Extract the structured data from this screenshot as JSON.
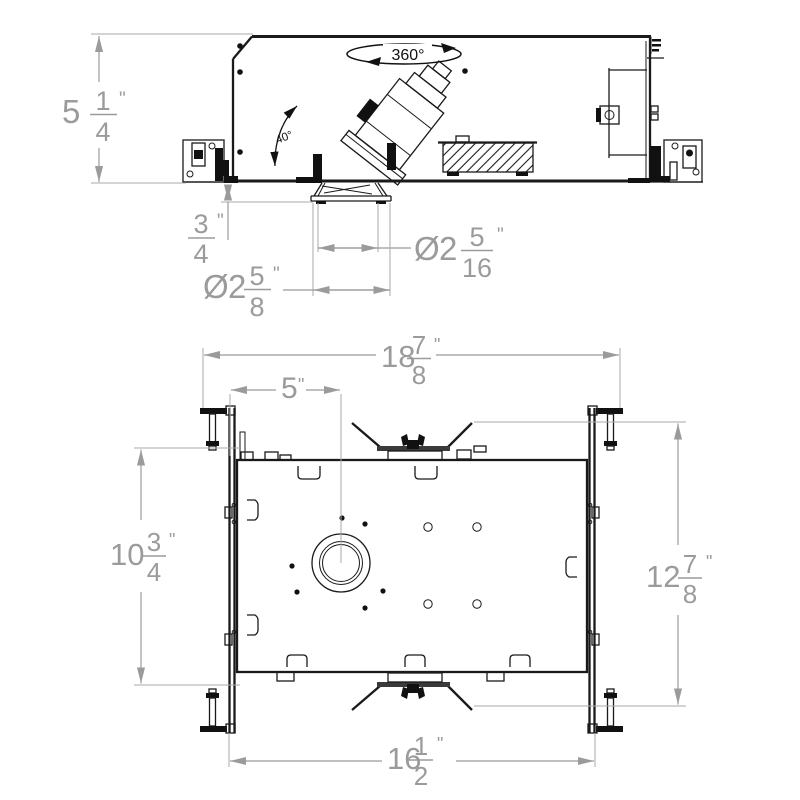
{
  "drawing": {
    "type": "technical-dimension-drawing",
    "subject": "recessed-downlight-housing",
    "colors": {
      "line": "#1a1a1a",
      "dimension": "#9b9b9b",
      "annotation_text": "#111111"
    },
    "annotations": {
      "rotation": "360°",
      "tilt": "40°"
    },
    "side_view": {
      "dims": {
        "housing_height": {
          "whole": "5",
          "num": "1",
          "den": "4",
          "unit": "\""
        },
        "trim_depth": {
          "whole": "",
          "num": "3",
          "den": "4",
          "unit": "\""
        },
        "trim_diameter": {
          "prefix": "Ø",
          "whole": "2",
          "num": "5",
          "den": "8",
          "unit": "\""
        },
        "aperture_diameter": {
          "prefix": "Ø",
          "whole": "2",
          "num": "5",
          "den": "16",
          "unit": "\""
        }
      }
    },
    "plan_view": {
      "dims": {
        "overall_width": {
          "whole": "18",
          "num": "7",
          "den": "8",
          "unit": "\""
        },
        "center_offset": {
          "whole": "5",
          "num": "",
          "den": "",
          "unit": "\""
        },
        "housing_length": {
          "whole": "10",
          "num": "3",
          "den": "4",
          "unit": "\""
        },
        "bar_length": {
          "whole": "12",
          "num": "7",
          "den": "8",
          "unit": "\""
        },
        "bar_span": {
          "whole": "16",
          "num": "1",
          "den": "2",
          "unit": "\""
        }
      }
    }
  }
}
